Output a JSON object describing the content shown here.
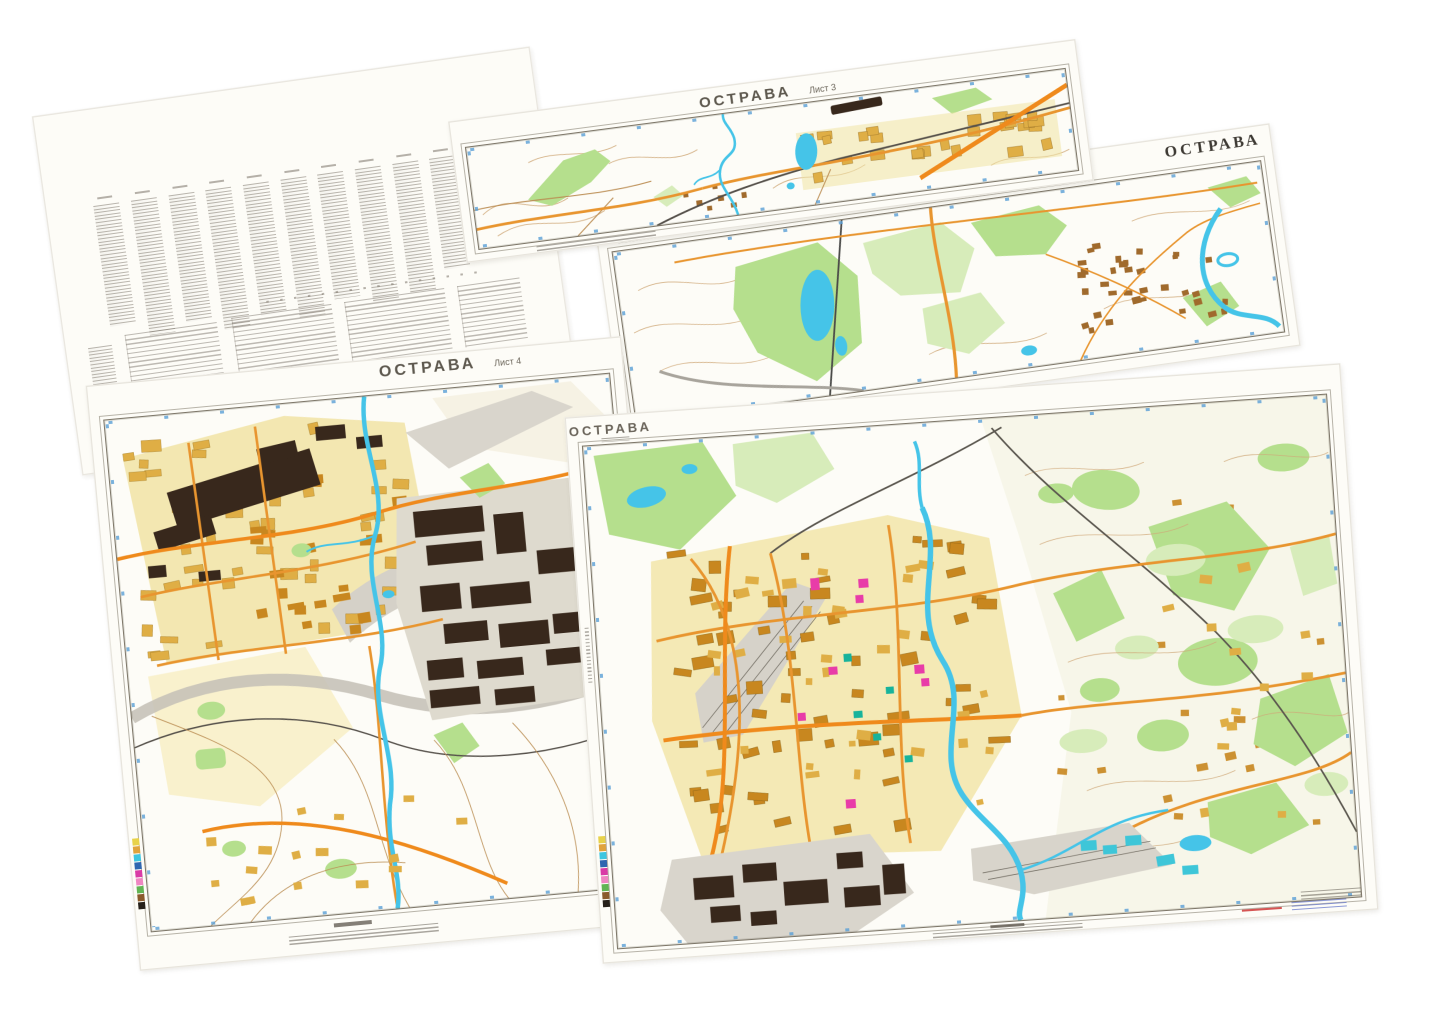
{
  "sheets": {
    "sheet_3": {
      "title": "ОСТРАВА",
      "sheet_label": "Лист 3"
    },
    "sheet_ne": {
      "title": "ОСТРАВА"
    },
    "sheet_4": {
      "title": "ОСТРАВА",
      "sheet_label": "Лист 4"
    },
    "sheet_sw": {
      "title": "ОСТРАВА"
    }
  },
  "colors": {
    "paper": "#fdfcf7",
    "neat": "#7d7668",
    "tick": "#5a9fd6",
    "contour": "#cfa878",
    "forest": "#b5df8d",
    "forest-light": "#d7ecba",
    "water": "#45c4e8",
    "road": "#e8952f",
    "road-bright": "#ef8a1c",
    "gold": "#dfae45",
    "gold-deep": "#c8871f",
    "pale-gold": "#f1e3a4",
    "dark": "#38281c",
    "village": "#a06a2c",
    "magenta": "#e83ca8",
    "teal": "#17b39b",
    "note-red": "#cc2a2a",
    "note-blue": "#6677cc"
  },
  "strip_colors": [
    "#e8d24a",
    "#e0a33c",
    "#3ec6e0",
    "#2f66b0",
    "#d93ba6",
    "#ef86c2",
    "#62b454",
    "#8a5a2c",
    "#26201a"
  ]
}
